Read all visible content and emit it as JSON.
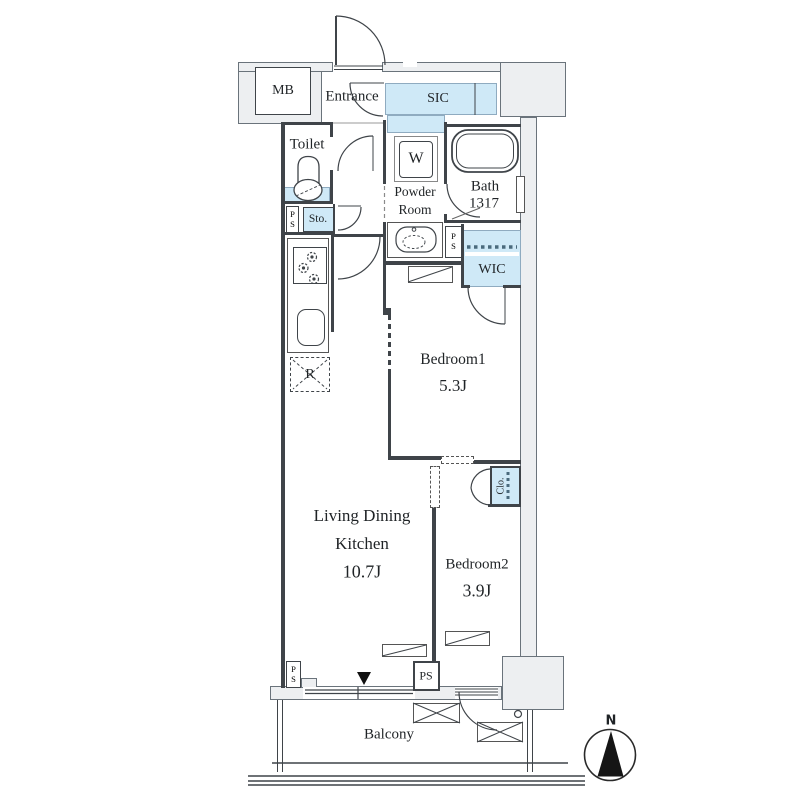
{
  "floorplan": {
    "labels": {
      "mb": "MB",
      "entrance": "Entrance",
      "sic": "SIC",
      "toilet": "Toilet",
      "washer": "W",
      "powder_room": [
        "Powder",
        "Room"
      ],
      "bath": "Bath",
      "bath_size": "1317",
      "sto": "Sto.",
      "wic": "WIC",
      "ps": "PS",
      "ps_stacked": [
        "P",
        "S"
      ],
      "bedroom1": "Bedroom1",
      "bedroom1_size": "5.3J",
      "refrigerator": "R",
      "ldk": [
        "Living Dining",
        "Kitchen"
      ],
      "ldk_size": "10.7J",
      "bedroom2": "Bedroom2",
      "bedroom2_size": "3.9J",
      "closet": "Clo.",
      "balcony": "Balcony",
      "north": "N"
    },
    "colors": {
      "storage_fill": "#cfe9f7",
      "wall_fill": "#edeff1",
      "line": "#3f4449"
    }
  }
}
